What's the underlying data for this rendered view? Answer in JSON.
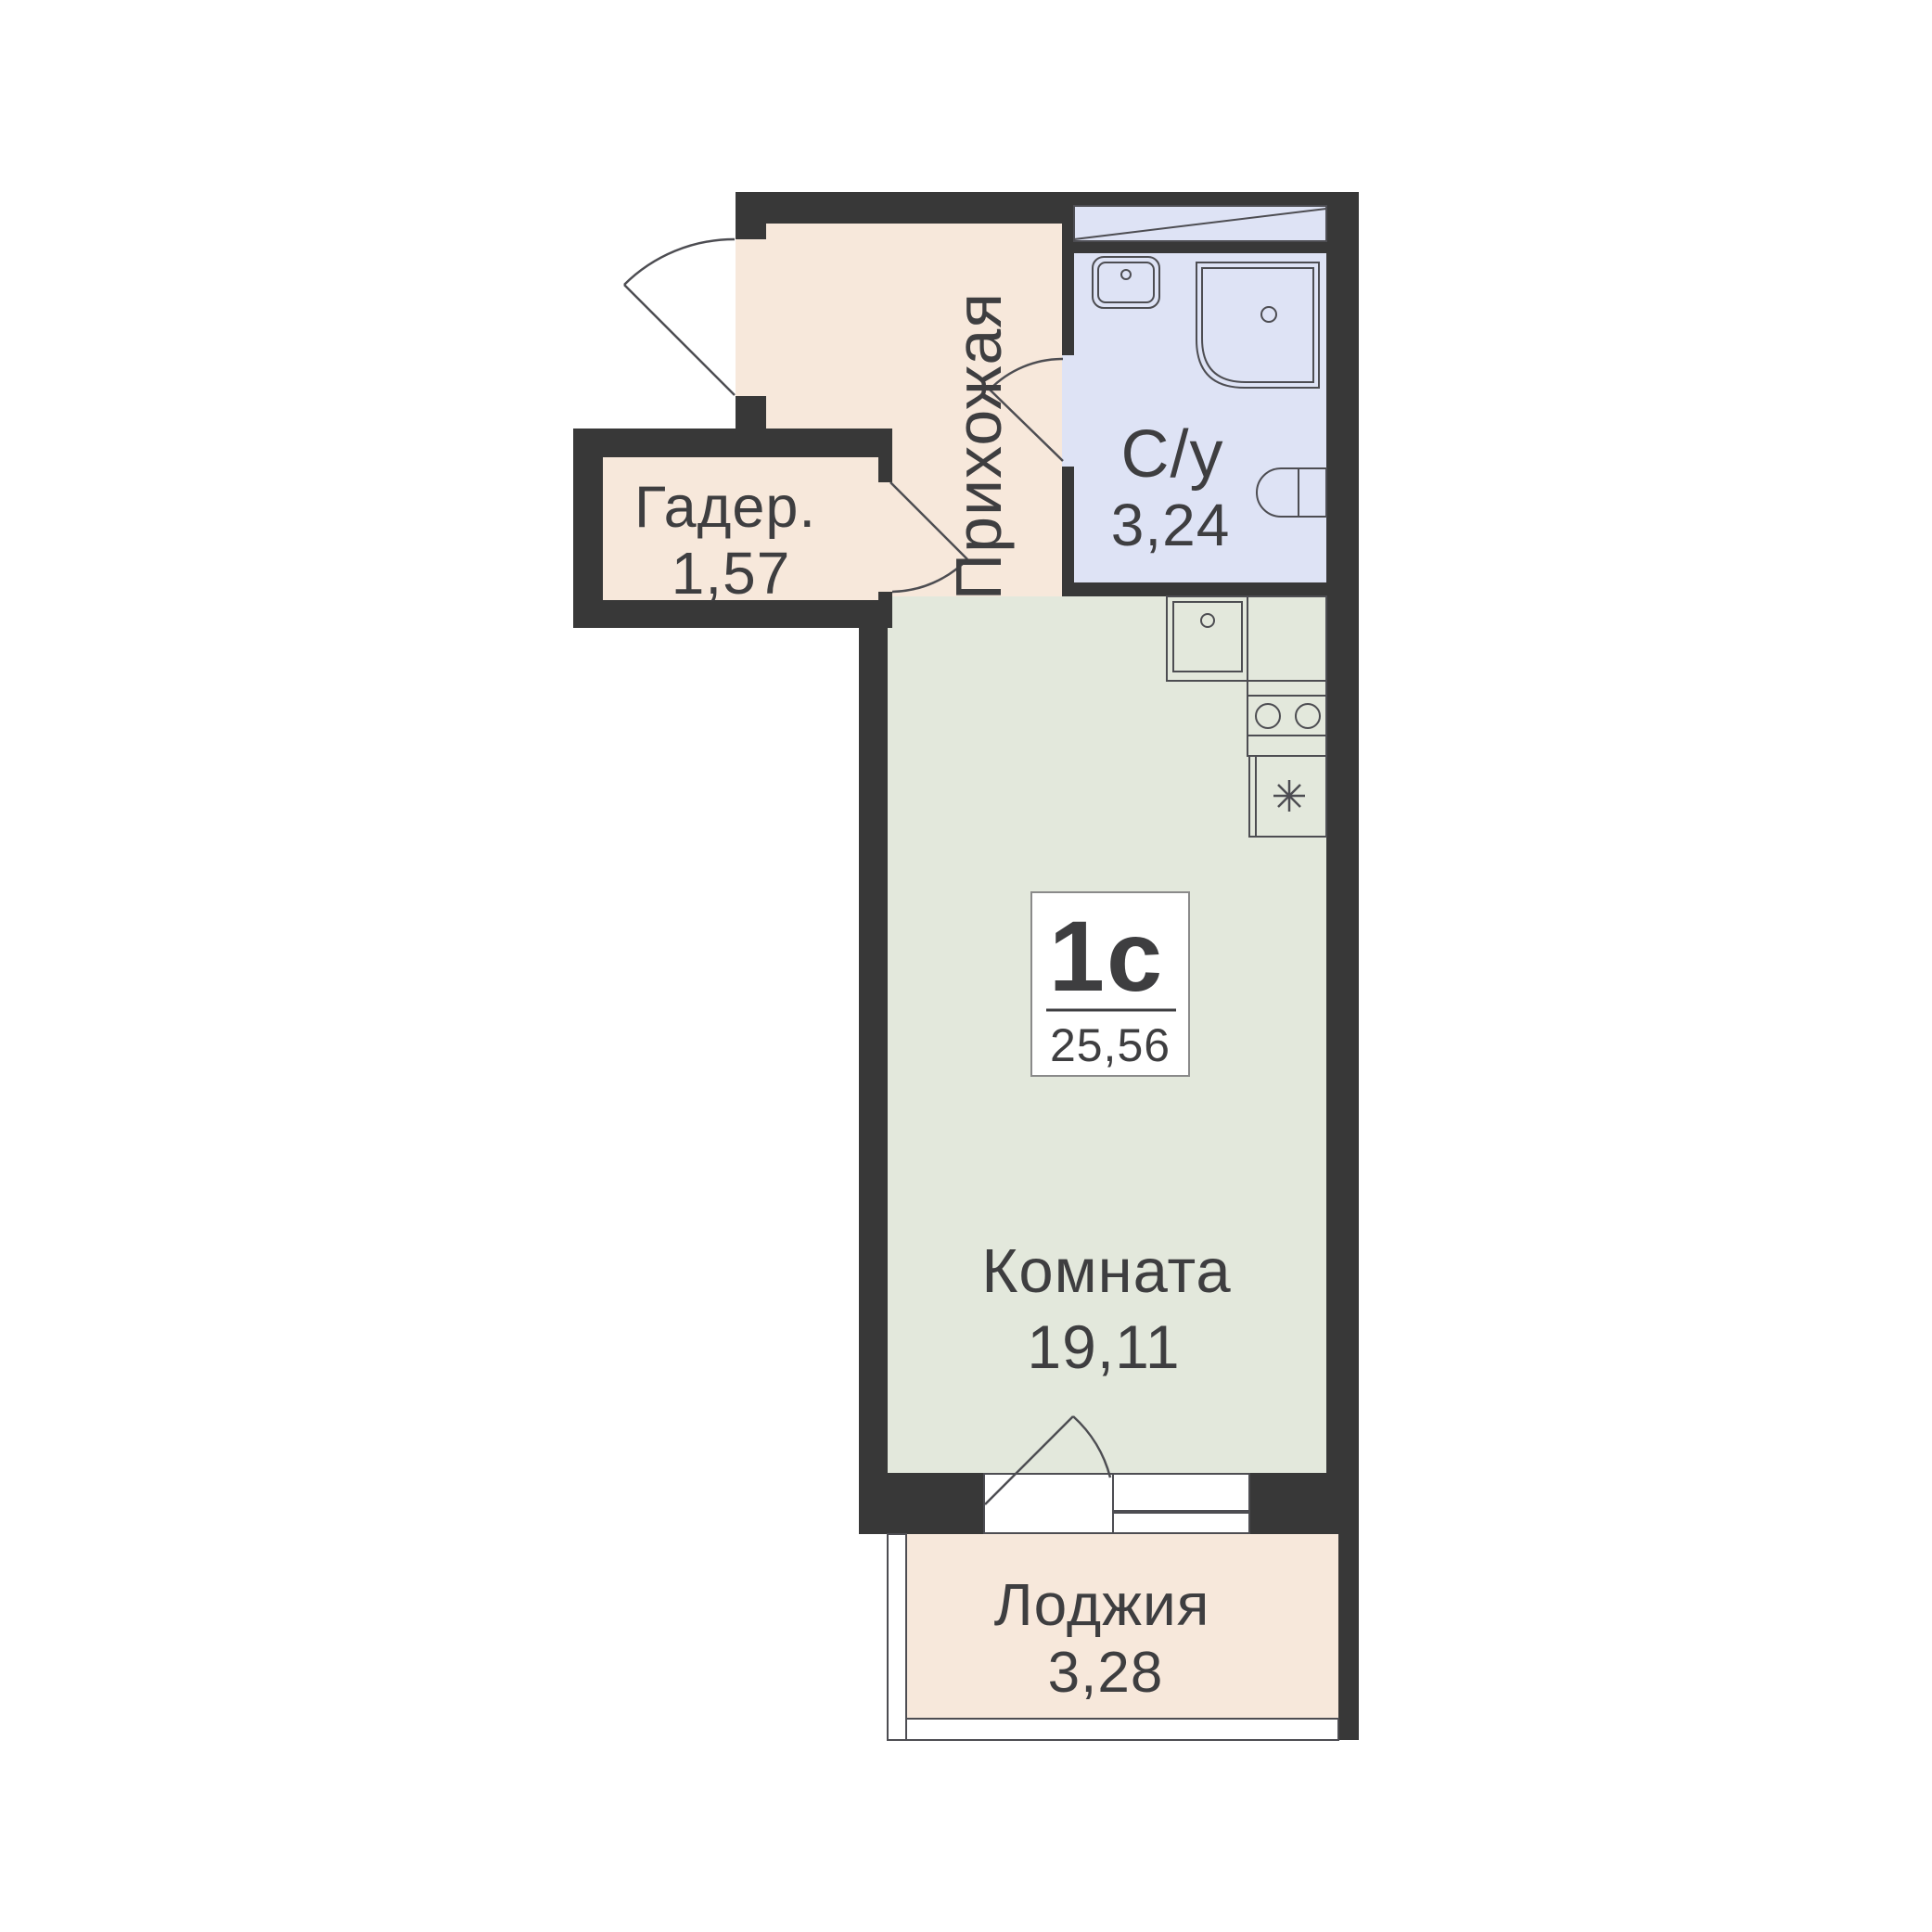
{
  "badge": {
    "unit_type": "1с",
    "total_area": "25,56"
  },
  "rooms": {
    "hallway": {
      "label": "Прихожая"
    },
    "wardrobe": {
      "label": "Гадер.",
      "area": "1,57"
    },
    "bathroom": {
      "label": "С/у",
      "area": "3,24"
    },
    "living_room": {
      "label": "Комната",
      "area": "19,11"
    },
    "loggia": {
      "label": "Лоджия",
      "area": "3,28"
    }
  },
  "colors": {
    "canvas_bg": "#ffffff",
    "wall": "#383838",
    "hallway_fill": "#f7e8db",
    "wardrobe_fill": "#f7e8db",
    "bathroom_fill": "#dee3f5",
    "living_room_fill": "#e3e8dc",
    "loggia_fill": "#f7e8db",
    "fixture_line": "#4d4d52",
    "text": "#3e3e40",
    "badge_bg": "#ffffff",
    "badge_border": "#8a8a8a"
  }
}
